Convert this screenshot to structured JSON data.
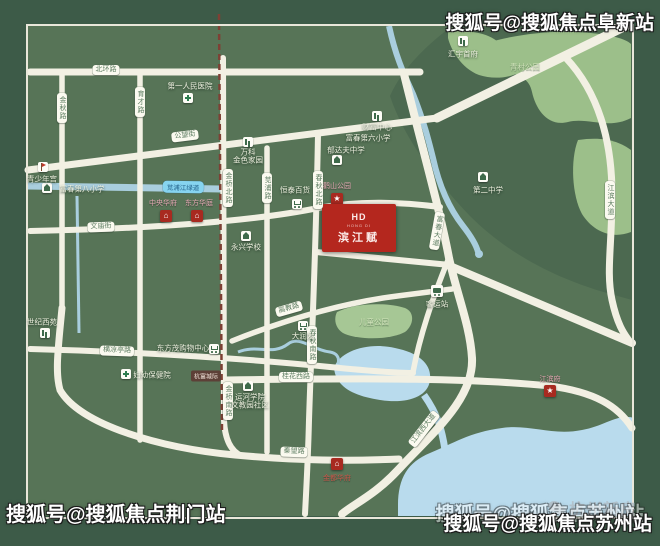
{
  "watermarks": {
    "top_right": "搜狐号@搜狐焦点阜新站",
    "bottom_left": "搜狐号@搜狐焦点荆门站",
    "bottom_right": "搜狐号@搜狐焦点苏州站",
    "brand": "杭州新房"
  },
  "project": {
    "logo": "HD",
    "tagline": "HONG DI",
    "name": "滨江赋"
  },
  "colors": {
    "map_bg": "#577457",
    "mat": "#3d5b48",
    "forest": "#4c6950",
    "park": "#a6c795",
    "water": "#b9dbed",
    "road": "#f2f0e3",
    "project_red": "#b4271e",
    "marker_red": "#a82a20",
    "rail": "#7e4034"
  },
  "road_labels": [
    {
      "t": "北环路",
      "x": 106,
      "y": 70
    },
    {
      "t": "金秋路",
      "x": 62,
      "y": 108,
      "vert": true
    },
    {
      "t": "育才路",
      "x": 140,
      "y": 102,
      "vert": true
    },
    {
      "t": "公望街",
      "x": 185,
      "y": 136,
      "rot": -7
    },
    {
      "t": "文庙街",
      "x": 101,
      "y": 227,
      "rot": -2
    },
    {
      "t": "金桥北路",
      "x": 228,
      "y": 188,
      "vert": true
    },
    {
      "t": "苋浦路",
      "x": 267,
      "y": 188,
      "vert": true
    },
    {
      "t": "春秋北路",
      "x": 318,
      "y": 190,
      "vert": true
    },
    {
      "t": "富春大道",
      "x": 437,
      "y": 231,
      "vert": true,
      "rot": 10
    },
    {
      "t": "江滨大道",
      "x": 610,
      "y": 200,
      "vert": true
    },
    {
      "t": "高教路",
      "x": 289,
      "y": 309,
      "rot": -16
    },
    {
      "t": "春秋南路",
      "x": 312,
      "y": 345,
      "vert": true
    },
    {
      "t": "横凉亭路",
      "x": 117,
      "y": 351,
      "rot": 2
    },
    {
      "t": "金桥南路",
      "x": 228,
      "y": 401,
      "vert": true
    },
    {
      "t": "桂花西路",
      "x": 296,
      "y": 377
    },
    {
      "t": "秦望路",
      "x": 294,
      "y": 452,
      "rot": 2
    },
    {
      "t": "江滨西大道",
      "x": 424,
      "y": 429,
      "rot": -52
    }
  ],
  "water_labels": [
    {
      "t": "苋浦江绿道",
      "x": 183,
      "y": 187,
      "rot": 1
    }
  ],
  "rail_labels": [
    {
      "t": "杭富城际",
      "x": 206,
      "y": 376
    }
  ],
  "icons": [
    {
      "kind": "flag",
      "x": 43,
      "y": 167
    },
    {
      "kind": "school",
      "x": 47,
      "y": 188
    },
    {
      "kind": "cross",
      "x": 188,
      "y": 98
    },
    {
      "kind": "building",
      "x": 248,
      "y": 142
    },
    {
      "kind": "building",
      "x": 463,
      "y": 41
    },
    {
      "kind": "building",
      "x": 377,
      "y": 116
    },
    {
      "kind": "school",
      "x": 337,
      "y": 160
    },
    {
      "kind": "school",
      "x": 483,
      "y": 177
    },
    {
      "kind": "cart",
      "x": 297,
      "y": 204
    },
    {
      "kind": "school",
      "x": 246,
      "y": 236
    },
    {
      "kind": "bus",
      "x": 437,
      "y": 291
    },
    {
      "kind": "cart",
      "x": 303,
      "y": 326
    },
    {
      "kind": "building",
      "x": 45,
      "y": 333
    },
    {
      "kind": "cart",
      "x": 214,
      "y": 349
    },
    {
      "kind": "cross",
      "x": 126,
      "y": 374
    },
    {
      "kind": "school",
      "x": 248,
      "y": 386
    }
  ],
  "markers": [
    {
      "kind": "star",
      "glyph": "★",
      "x": 337,
      "y": 199
    },
    {
      "kind": "star",
      "glyph": "★",
      "x": 550,
      "y": 391
    },
    {
      "kind": "home",
      "glyph": "⌂",
      "x": 166,
      "y": 216
    },
    {
      "kind": "home",
      "glyph": "⌂",
      "x": 197,
      "y": 216
    },
    {
      "kind": "home",
      "glyph": "⌂",
      "x": 337,
      "y": 464
    }
  ],
  "labels_white": [
    {
      "t": "青少年宫",
      "x": 42,
      "y": 179
    },
    {
      "t": "第一人民医院",
      "x": 190,
      "y": 86
    },
    {
      "t": "富春第八小学",
      "x": 82,
      "y": 189
    },
    {
      "t": "万科",
      "x": 248,
      "y": 152
    },
    {
      "t": "金色家园",
      "x": 248,
      "y": 160
    },
    {
      "t": "汇宇首府",
      "x": 463,
      "y": 54
    },
    {
      "t": "财富中心",
      "x": 377,
      "y": 127
    },
    {
      "t": "富春第六小学",
      "x": 368,
      "y": 138
    },
    {
      "t": "郁达夫中学",
      "x": 346,
      "y": 150
    },
    {
      "t": "第二中学",
      "x": 488,
      "y": 190
    },
    {
      "t": "恒泰百货",
      "x": 295,
      "y": 190
    },
    {
      "t": "永兴学校",
      "x": 246,
      "y": 247
    },
    {
      "t": "客运站",
      "x": 437,
      "y": 304
    },
    {
      "t": "大润发",
      "x": 303,
      "y": 336
    },
    {
      "t": "世纪西苑",
      "x": 42,
      "y": 322
    },
    {
      "t": "东方茂购物中心",
      "x": 183,
      "y": 348
    },
    {
      "t": "妇幼保健院",
      "x": 152,
      "y": 375
    },
    {
      "t": "运河学院",
      "x": 250,
      "y": 397
    },
    {
      "t": "文教园社区",
      "x": 250,
      "y": 405
    }
  ],
  "labels_park": [
    {
      "t": "青村公园",
      "x": 525,
      "y": 67
    },
    {
      "t": "儿童公园",
      "x": 374,
      "y": 322
    }
  ],
  "labels_pink": [
    {
      "t": "中央华府",
      "x": 163,
      "y": 203
    },
    {
      "t": "东方华庭",
      "x": 199,
      "y": 203
    },
    {
      "t": "鹳山公园",
      "x": 337,
      "y": 186
    },
    {
      "t": "江滨府",
      "x": 550,
      "y": 379
    }
  ],
  "labels_red": [
    {
      "t": "金都华府",
      "x": 337,
      "y": 478
    }
  ]
}
